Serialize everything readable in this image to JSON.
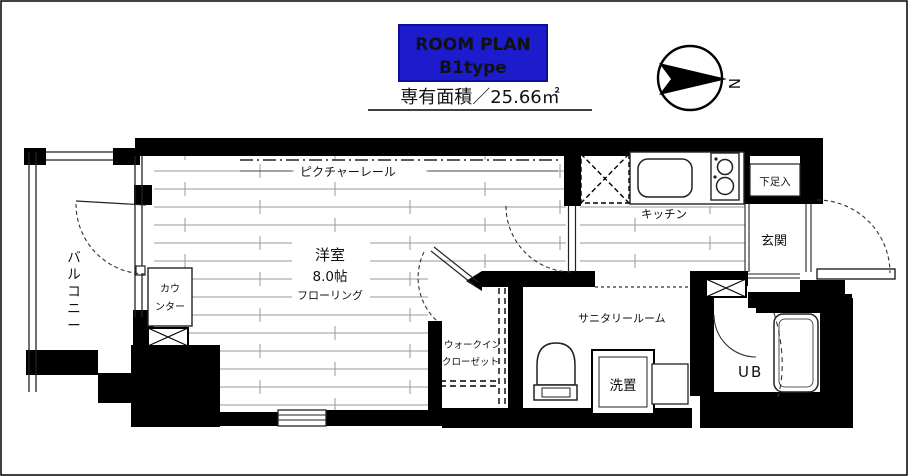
{
  "header": {
    "badge": {
      "line1": "ROOM PLAN",
      "line2": "B1type"
    },
    "area_label": "専有面積／25.66㎡",
    "compass_letter": "N"
  },
  "plan": {
    "balcony": "バルコニー",
    "room_name": "洋室",
    "room_size": "8.0帖",
    "room_floor": "フローリング",
    "picture_rail": "ピクチャーレール",
    "counter_line1": "カウ",
    "counter_line2": "ンター",
    "kitchen": "キッチン",
    "shoe_storage": "下足入",
    "entrance": "玄関",
    "sanitary": "サニタリールーム",
    "laundry": "洗置",
    "wic_line1": "ウォークイン",
    "wic_line2": "クローゼット",
    "unit_bath": "UB"
  },
  "colors": {
    "badge_bg": "#1c1ccd",
    "badge_text": "#ffffff",
    "wall": "#000000",
    "floor_line": "#999999"
  }
}
